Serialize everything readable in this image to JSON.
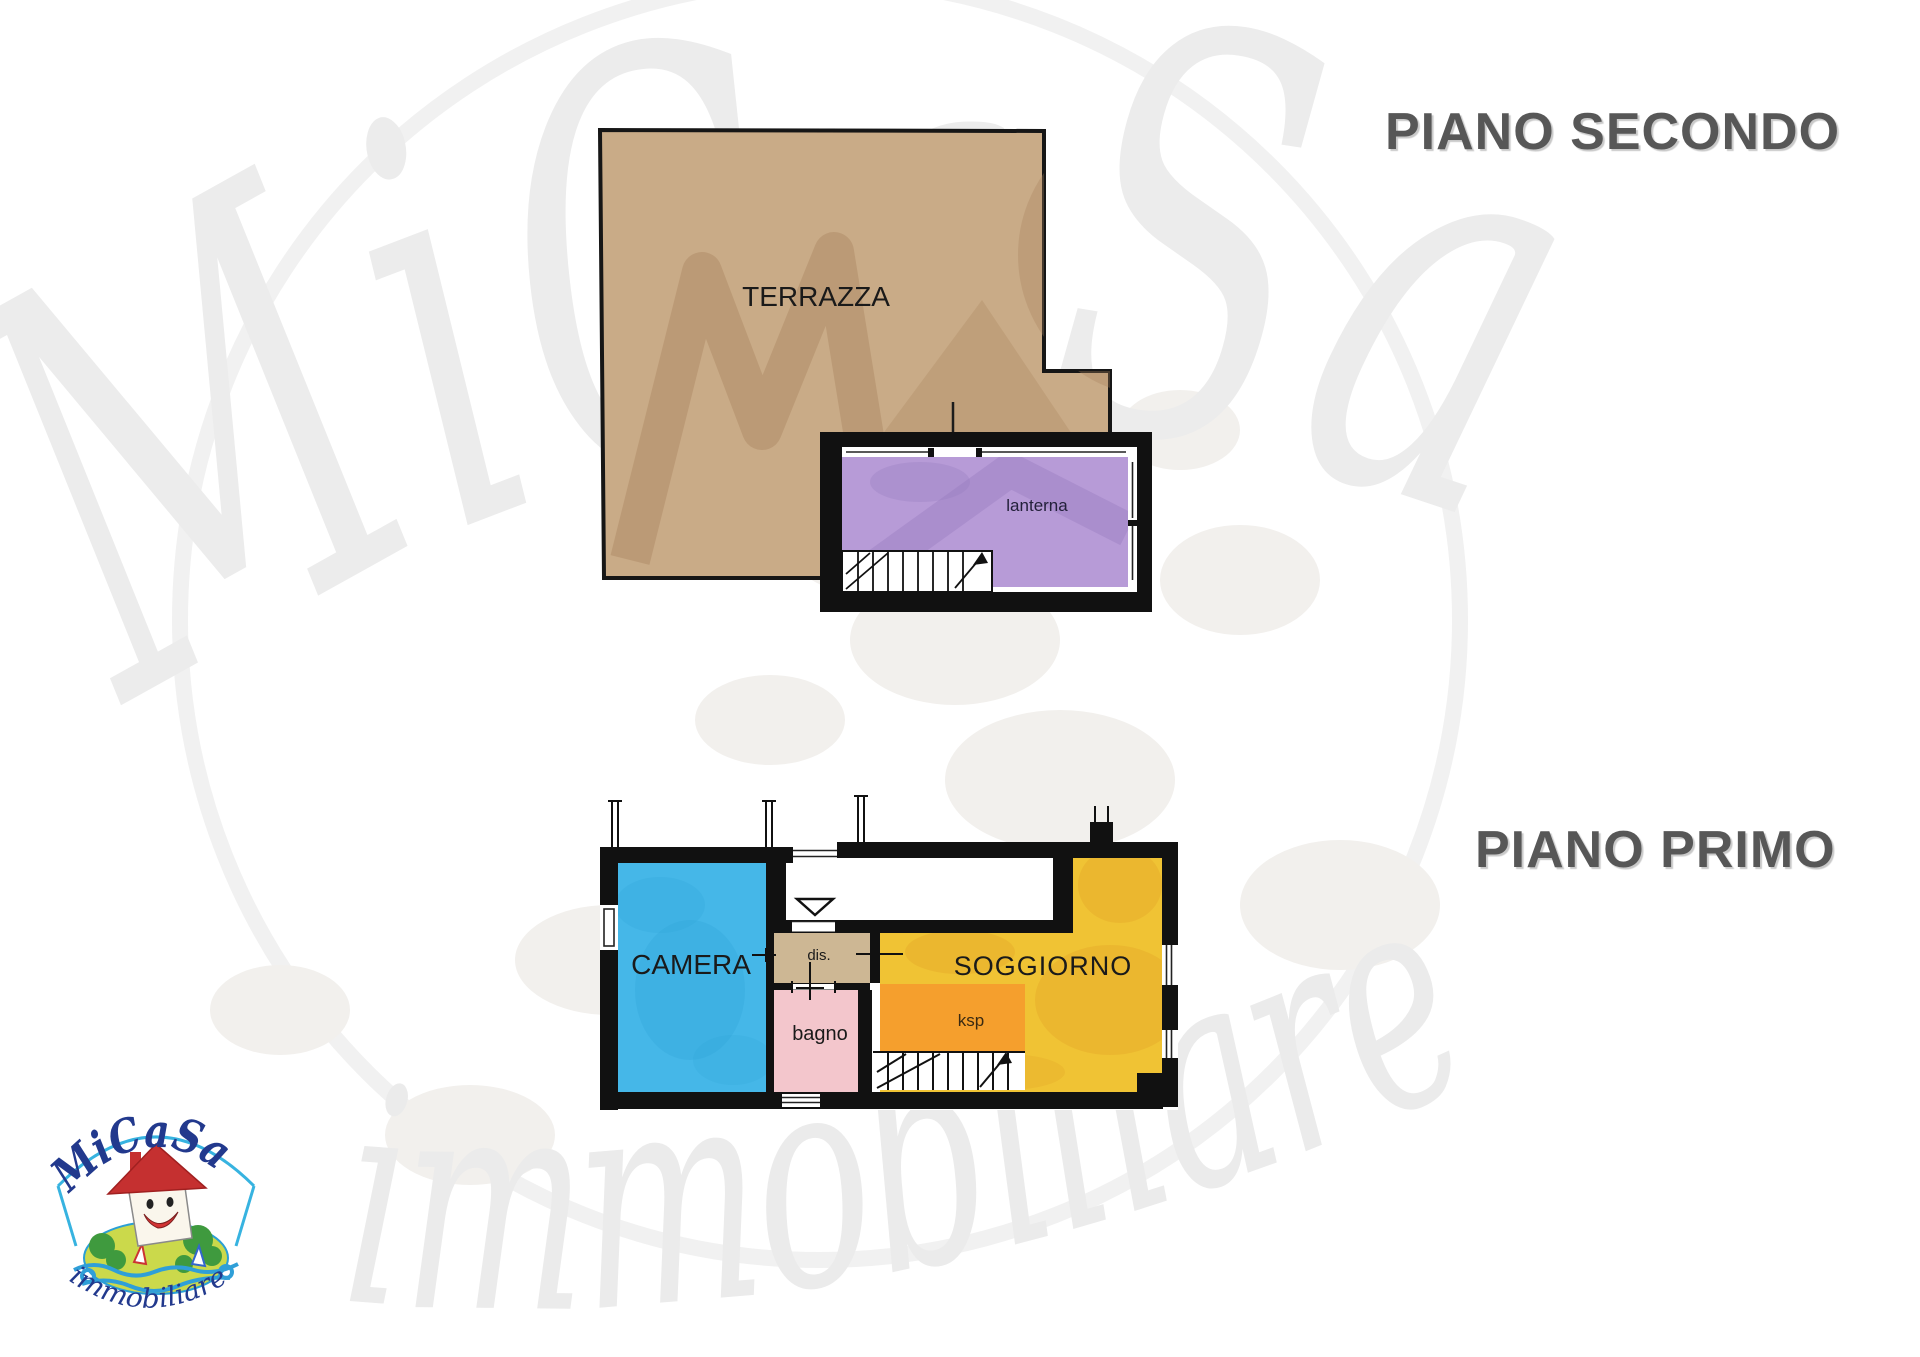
{
  "floors": {
    "second": {
      "title": "PIANO SECONDO",
      "rooms": [
        {
          "label": "TERRAZZA"
        },
        {
          "label": "lanterna"
        }
      ]
    },
    "first": {
      "title": "PIANO PRIMO",
      "rooms": [
        {
          "label": "CAMERA"
        },
        {
          "label": "dis."
        },
        {
          "label": "bagno"
        },
        {
          "label": "SOGGIORNO"
        },
        {
          "label": "ksp"
        }
      ]
    }
  },
  "logo": {
    "brand": "MiCaSa",
    "tagline": "immobiliare"
  },
  "watermark": {
    "brand": "MiCaSa",
    "tagline": "immobiliare"
  },
  "colors": {
    "terrace": "#c9ab87",
    "lantern": "#b79bd7",
    "bedroom": "#45b7e8",
    "hall": "#cdb794",
    "bath": "#f3c6cc",
    "living": "#f0c334",
    "ksp": "#f59f2d",
    "walls": "#111111",
    "title_text": "#575757",
    "logo_blue": "#22398d",
    "logo_red": "#c53030",
    "watermark_gray": "#ececec"
  }
}
